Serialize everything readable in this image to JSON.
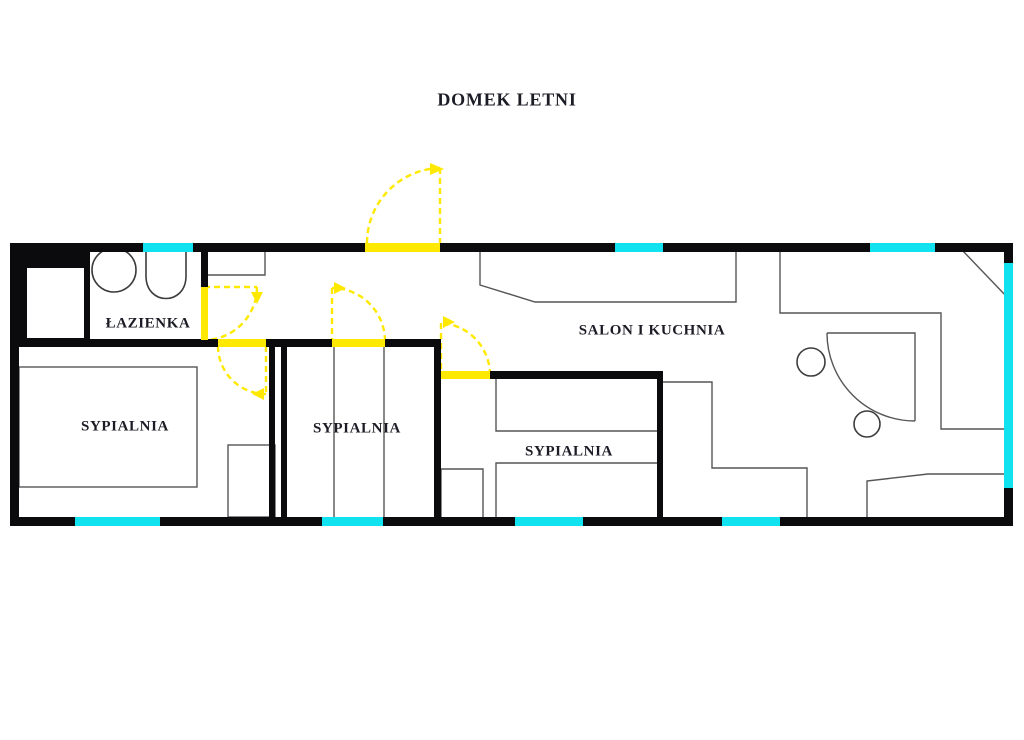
{
  "plan": {
    "title": "DOMEK LETNI",
    "rooms": {
      "bathroom": {
        "label": "ŁAZIENKA"
      },
      "bedroom_left": {
        "label": "SYPIALNIA"
      },
      "bedroom_middle": {
        "label": "SYPIALNIA"
      },
      "bedroom_right": {
        "label": "SYPIALNIA"
      },
      "living_kitchen": {
        "label": "SALON I KUCHNIA"
      }
    },
    "colors": {
      "wall": "#0b0b0d",
      "window": "#10e2ef",
      "door": "#ffe900",
      "line": "#555555",
      "text": "#1c1c26"
    }
  }
}
